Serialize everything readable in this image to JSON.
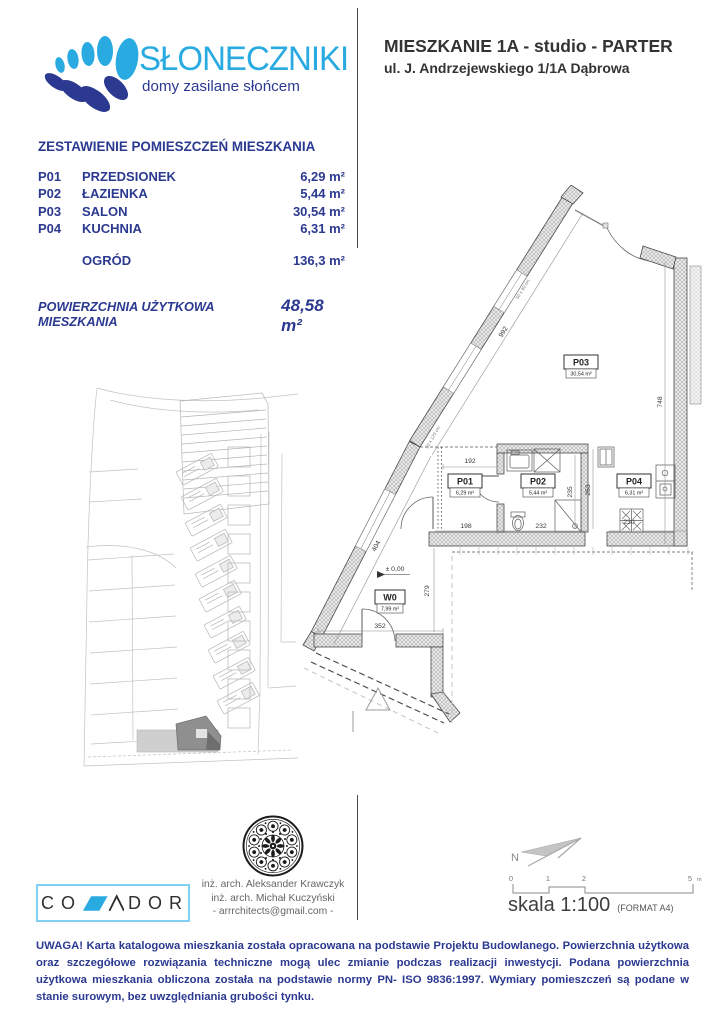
{
  "brand": {
    "name": "SŁONECZNIKI",
    "tagline": "domy zasilane słońcem"
  },
  "header": {
    "title": "MIESZKANIE 1A - studio - PARTER",
    "address": "ul. J. Andrzejewskiego 1/1A Dąbrowa"
  },
  "rooms_table": {
    "title": "ZESTAWIENIE POMIESZCZEŃ MIESZKANIA",
    "rows": [
      {
        "code": "P01",
        "name": "PRZEDSIONEK",
        "area": "6,29 m²"
      },
      {
        "code": "P02",
        "name": "ŁAZIENKA",
        "area": "5,44 m²"
      },
      {
        "code": "P03",
        "name": "SALON",
        "area": "30,54 m²"
      },
      {
        "code": "P04",
        "name": "KUCHNIA",
        "area": "6,31 m²"
      },
      {
        "code": "",
        "name": "OGRÓD",
        "area": "136,3 m²"
      }
    ],
    "total_label": "POWIERZCHNIA UŻYTKOWA MIESZKANIA",
    "total_area": "48,58 m²"
  },
  "floor_plan": {
    "rooms": {
      "p01": {
        "code": "P01",
        "area": "6,29 m²"
      },
      "p02": {
        "code": "P02",
        "area": "5,44 m²"
      },
      "p03": {
        "code": "P03",
        "area": "30,54 m²"
      },
      "p04": {
        "code": "P04",
        "area": "6,31 m²"
      },
      "w0": {
        "code": "W0",
        "area": "7,99 m²"
      }
    },
    "level_marker": "± 0,00",
    "dims": {
      "diag_upper": "992",
      "diag_lower": "404",
      "right_wall": "748",
      "w0_width": "352",
      "w0_height": "279",
      "p01_top": "192",
      "p01_bottom": "198",
      "p02_bottom": "232",
      "p02_height": "235",
      "corridor": "253",
      "kitchen_bottom": "230"
    },
    "window_notes": {
      "upper": "50 x 90 cm",
      "lower": "50 x 120 cm"
    }
  },
  "credits": {
    "line1": "inż. arch. Aleksander Krawczyk",
    "line2": "inż. arch. Michał Kuczyński",
    "line3": "-  arrrchitects@gmail.com  -"
  },
  "covador": {
    "left": [
      "C",
      "O"
    ],
    "right": [
      "D",
      "O",
      "R"
    ]
  },
  "compass": {
    "label": "N"
  },
  "scale": {
    "t0": "0",
    "t1": "1",
    "t2": "2",
    "t3": "5",
    "unit": "m",
    "label": "skala 1:100",
    "format": "(FORMAT A4)"
  },
  "footer": {
    "text": "UWAGA! Karta katalogowa mieszkania została opracowana na podstawie Projektu Budowlanego. Powierzchnia użytkowa oraz szczegółowe rozwiązania techniczne mogą ulec zmianie podczas realizacji inwestycji. Podana powierzchnia użytkowa mieszkania obliczona została na podstawie normy PN- ISO 9836:1997. Wymiary pomieszczeń są podane w stanie surowym, bez uwzględniania grubości tynku."
  },
  "colors": {
    "accent_light": "#29ABE2",
    "accent_dark": "#2B3990",
    "ink": "#333333"
  }
}
